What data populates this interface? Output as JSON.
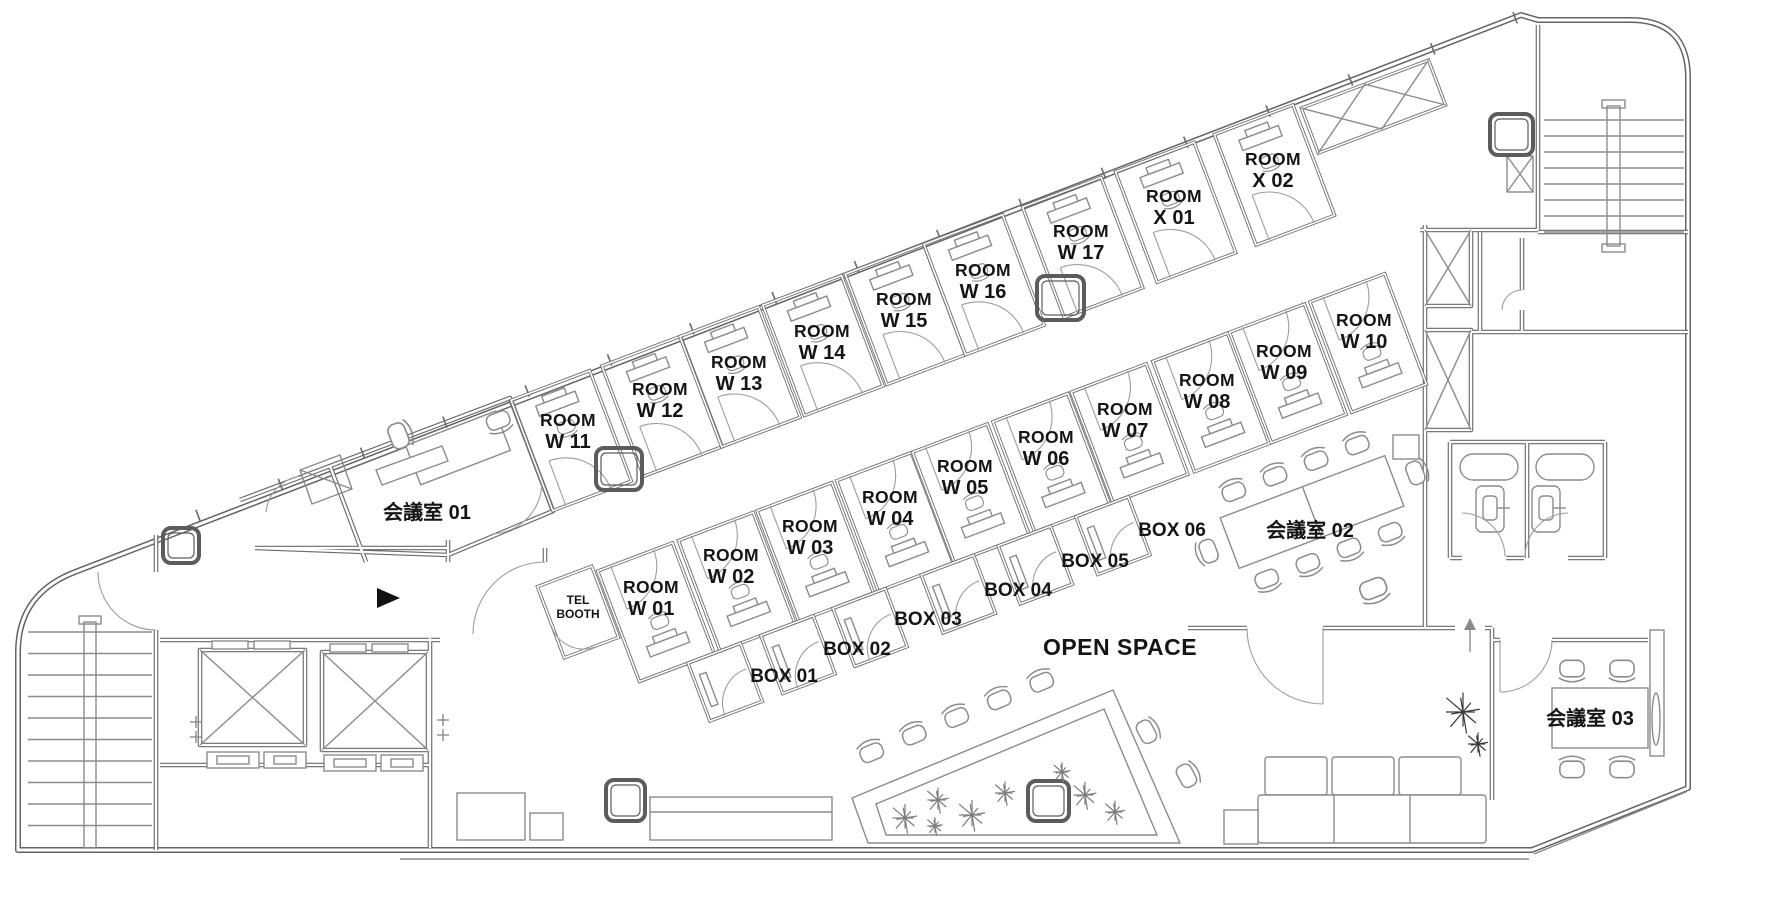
{
  "plan": {
    "colors": {
      "wall": "#636363",
      "furniture": "#8b8b8b",
      "text": "#151515",
      "plant": "#7d7d7d",
      "plant_dark": "#383838",
      "entrance_marker": "#111111"
    },
    "bands": {
      "top": [
        {
          "id": "room-w11",
          "line1": "ROOM",
          "line2": "W 11",
          "x": 568,
          "y": 432
        },
        {
          "id": "room-w12",
          "line1": "ROOM",
          "line2": "W 12",
          "x": 660,
          "y": 401
        },
        {
          "id": "room-w13",
          "line1": "ROOM",
          "line2": "W 13",
          "x": 739,
          "y": 374
        },
        {
          "id": "room-w14",
          "line1": "ROOM",
          "line2": "W 14",
          "x": 822,
          "y": 343
        },
        {
          "id": "room-w15",
          "line1": "ROOM",
          "line2": "W 15",
          "x": 904,
          "y": 311
        },
        {
          "id": "room-w16",
          "line1": "ROOM",
          "line2": "W 16",
          "x": 983,
          "y": 282
        },
        {
          "id": "room-w17",
          "line1": "ROOM",
          "line2": "W 17",
          "x": 1081,
          "y": 243
        },
        {
          "id": "room-x01",
          "line1": "ROOM",
          "line2": "X 01",
          "x": 1174,
          "y": 208
        },
        {
          "id": "room-x02",
          "line1": "ROOM",
          "line2": "X 02",
          "x": 1273,
          "y": 171
        }
      ],
      "middle": [
        {
          "id": "room-w01",
          "line1": "ROOM",
          "line2": "W 01",
          "x": 651,
          "y": 599
        },
        {
          "id": "room-w02",
          "line1": "ROOM",
          "line2": "W 02",
          "x": 731,
          "y": 567
        },
        {
          "id": "room-w03",
          "line1": "ROOM",
          "line2": "W 03",
          "x": 810,
          "y": 538
        },
        {
          "id": "room-w04",
          "line1": "ROOM",
          "line2": "W 04",
          "x": 890,
          "y": 509
        },
        {
          "id": "room-w05",
          "line1": "ROOM",
          "line2": "W 05",
          "x": 965,
          "y": 478
        },
        {
          "id": "room-w06",
          "line1": "ROOM",
          "line2": "W 06",
          "x": 1046,
          "y": 449
        },
        {
          "id": "room-w07",
          "line1": "ROOM",
          "line2": "W 07",
          "x": 1125,
          "y": 421
        },
        {
          "id": "room-w08",
          "line1": "ROOM",
          "line2": "W 08",
          "x": 1207,
          "y": 392
        },
        {
          "id": "room-w09",
          "line1": "ROOM",
          "line2": "W 09",
          "x": 1284,
          "y": 363
        },
        {
          "id": "room-w10",
          "line1": "ROOM",
          "line2": "W 10",
          "x": 1364,
          "y": 332
        }
      ],
      "boxes": [
        {
          "id": "box-01",
          "label": "BOX 01",
          "x": 772,
          "y": 676
        },
        {
          "id": "box-02",
          "label": "BOX 02",
          "x": 845,
          "y": 649
        },
        {
          "id": "box-03",
          "label": "BOX 03",
          "x": 916,
          "y": 619
        },
        {
          "id": "box-04",
          "label": "BOX 04",
          "x": 1006,
          "y": 590
        },
        {
          "id": "box-05",
          "label": "BOX 05",
          "x": 1083,
          "y": 561
        },
        {
          "id": "box-06",
          "label": "BOX 06",
          "x": 1160,
          "y": 530
        }
      ]
    },
    "areas": [
      {
        "id": "meeting-room-01",
        "label": "会議室 01",
        "x": 427,
        "y": 512
      },
      {
        "id": "meeting-room-02",
        "label": "会議室 02",
        "x": 1310,
        "y": 530
      },
      {
        "id": "meeting-room-03",
        "label": "会議室 03",
        "x": 1590,
        "y": 718
      },
      {
        "id": "open-space",
        "label": "OPEN SPACE",
        "x": 1120,
        "y": 648
      }
    ],
    "tel_booth": {
      "id": "tel-booth",
      "line1": "TEL",
      "line2": "BOOTH",
      "x": 578,
      "y": 604
    }
  }
}
